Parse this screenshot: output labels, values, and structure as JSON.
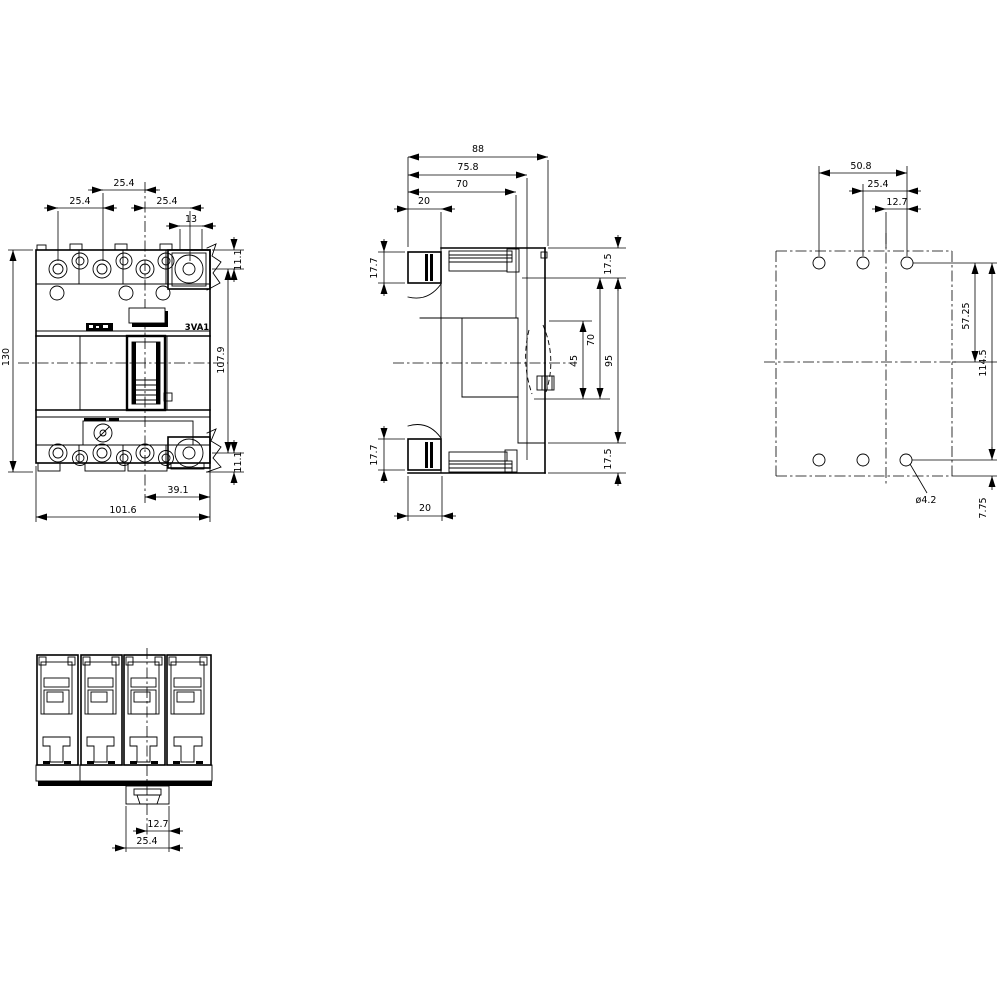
{
  "product_label": "3VA1",
  "front_view": {
    "dims": {
      "pitch_center": "25.4",
      "pitch_left": "25.4",
      "pitch_right": "25.4",
      "terminal_width": "13",
      "total_height": "130",
      "top_terminal_offset": "11.1",
      "terminal_span_height": "107.9",
      "bottom_terminal_offset": "11.1",
      "lug_center_to_edge": "39.1",
      "total_width": "101.6"
    }
  },
  "side_view": {
    "dims": {
      "total_depth": "88",
      "depth_step": "75.8",
      "depth_handle": "70",
      "terminal_depth_top": "20",
      "terminal_height_top": "17.7",
      "terminal_height_bottom": "17.7",
      "terminal_depth_bottom": "20",
      "top_offset": "17.5",
      "front_height": "95",
      "handle_pos_70": "70",
      "handle_pos_45": "45",
      "bottom_offset": "17.5"
    }
  },
  "rear_view": {
    "dims": {
      "hole_span": "50.8",
      "hole_pitch": "25.4",
      "hole_half_pitch": "12.7",
      "center_to_hole": "57.25",
      "hole_span_v": "114.5",
      "bottom_offset": "7.75",
      "hole_dia": "ø4.2"
    }
  },
  "bottom_view": {
    "dims": {
      "tab_half": "12.7",
      "tab_width": "25.4"
    }
  }
}
